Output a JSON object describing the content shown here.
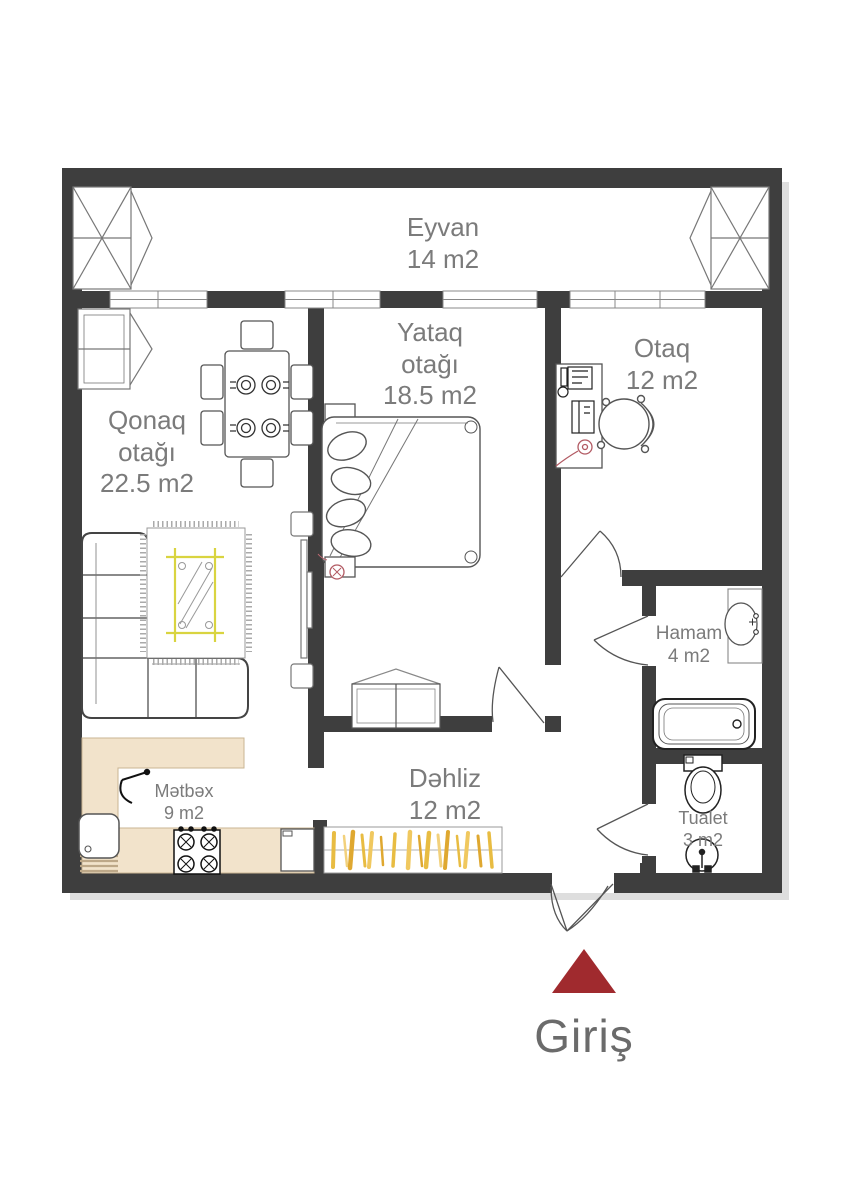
{
  "floorplan": {
    "rooms": [
      {
        "id": "eyvan",
        "name": "Eyvan",
        "area": "14 m2"
      },
      {
        "id": "yataq",
        "name": "Yataq otağı",
        "area": "18.5 m2"
      },
      {
        "id": "otaq",
        "name": "Otaq",
        "area": "12 m2"
      },
      {
        "id": "qonaq",
        "name": "Qonaq otağı",
        "area": "22.5 m2"
      },
      {
        "id": "hamam",
        "name": "Hamam",
        "area": "4 m2"
      },
      {
        "id": "dehliz",
        "name": "Dəhliz",
        "area": "12 m2"
      },
      {
        "id": "metbex",
        "name": "Mətbəx",
        "area": "9 m2"
      },
      {
        "id": "tualet",
        "name": "Tualet",
        "area": "3 m2"
      }
    ],
    "entrance_label": "Giriş",
    "furniture": [
      "balcony-window-left",
      "balcony-window-right",
      "corner-cabinet",
      "dining-table-set",
      "corner-sofa",
      "rug",
      "coffee-table",
      "tv-console",
      "double-bed",
      "nightstands",
      "dresser",
      "desk-with-computer",
      "office-chair",
      "bathroom-sink",
      "bathtub",
      "toilet",
      "wc-sink",
      "kitchen-counter",
      "kitchen-sink",
      "stove",
      "fridge",
      "wardrobe",
      "entrance-arrow"
    ],
    "colors": {
      "wall": "#3e3e3e",
      "counter_beige": "#f2e3cb",
      "wardrobe_yellow": "#e8bc42",
      "entrance_red": "#a02a2e",
      "label_gray": "#7b7b7b",
      "accent_red": "#b25a63"
    }
  }
}
